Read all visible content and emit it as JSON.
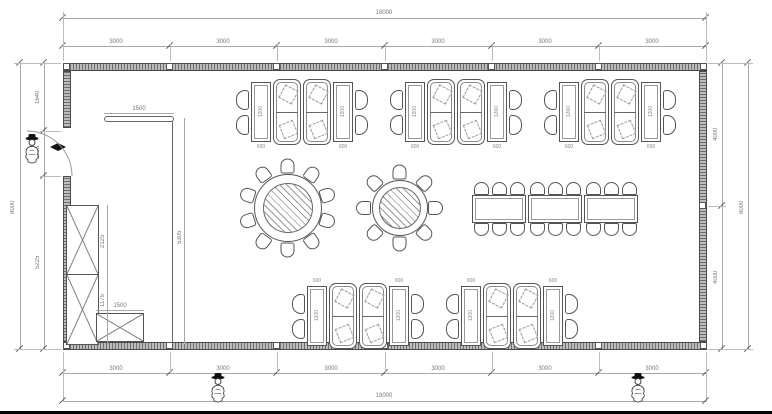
{
  "dimensions": {
    "top": {
      "overall": "18000",
      "segments": [
        "3000",
        "3000",
        "3000",
        "3000",
        "3000",
        "3000"
      ]
    },
    "bottom": {
      "overall": "18000",
      "segments": [
        "3000",
        "3000",
        "3000",
        "3000",
        "3000",
        "3000"
      ]
    },
    "left": {
      "overall": "8000",
      "segments": [
        "1640",
        "1135",
        "5225"
      ]
    },
    "right": {
      "overall": "8000",
      "segments": [
        "4000",
        "4000"
      ]
    },
    "details": {
      "table_width": "600",
      "table_length": "1200",
      "counter_length": "1500",
      "partition_height": "5305",
      "cabinet_upper": "2125",
      "cabinet_lower": "1175",
      "sideboard_length": "1500"
    }
  }
}
